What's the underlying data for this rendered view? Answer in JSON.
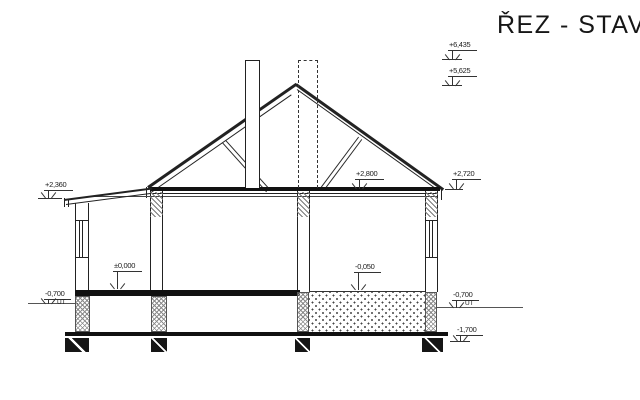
{
  "title": "ŘEZ - STAV",
  "drawing": {
    "background_color": "#ffffff",
    "line_color": "#222222"
  },
  "levels": {
    "ridge": "+6,435",
    "upper_roof": "+5,625",
    "porch_eave": "+2,360",
    "ceiling": "+2,800",
    "eave": "+2,720",
    "floor": "±0,000",
    "right_floor": "-0,050",
    "terrain_left": "-0,700",
    "terrain_right": "-0,700",
    "foundation_bottom": "-1,700",
    "terrain_label": "UT"
  }
}
